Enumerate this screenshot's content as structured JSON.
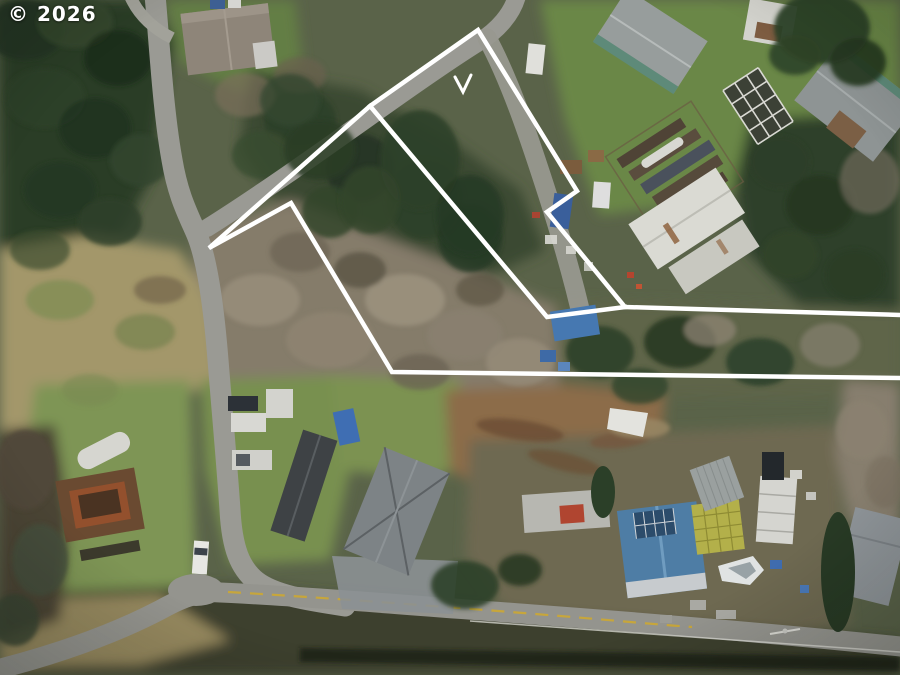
{
  "watermark": {
    "text": "© 2026",
    "color": "#ffffff"
  },
  "overlay": {
    "color": "#ffffff",
    "stroke_width": "4.5",
    "paths": [
      {
        "name": "parcel-outline",
        "points": "902,315 625,307 547,212 577,191 478,30 370,106 209,248 291,203 392,372 902,378"
      },
      {
        "name": "inner-division-line",
        "points": "370,106 547,317 625,307"
      }
    ],
    "marker": {
      "name": "v-checkmark",
      "points": "455,77 463,92 471,75",
      "stroke_width": "3"
    }
  },
  "scene": {
    "description": "Winter drone aerial photo of rural residential parcels, roads and forest with a white property-boundary outline drawn over the lots",
    "palette": {
      "conifer_dark": "#2c3e29",
      "bare_forest_gray": "#867d6c",
      "lawn_green": "#6e8a48",
      "meadow_tan": "#a5996c",
      "road_gray": "#989993",
      "dirt_brown": "#8d6d49",
      "blue_roof": "#4e7da6",
      "yellow_centerline": "#c7a63b",
      "boundary_white": "#ffffff"
    }
  }
}
